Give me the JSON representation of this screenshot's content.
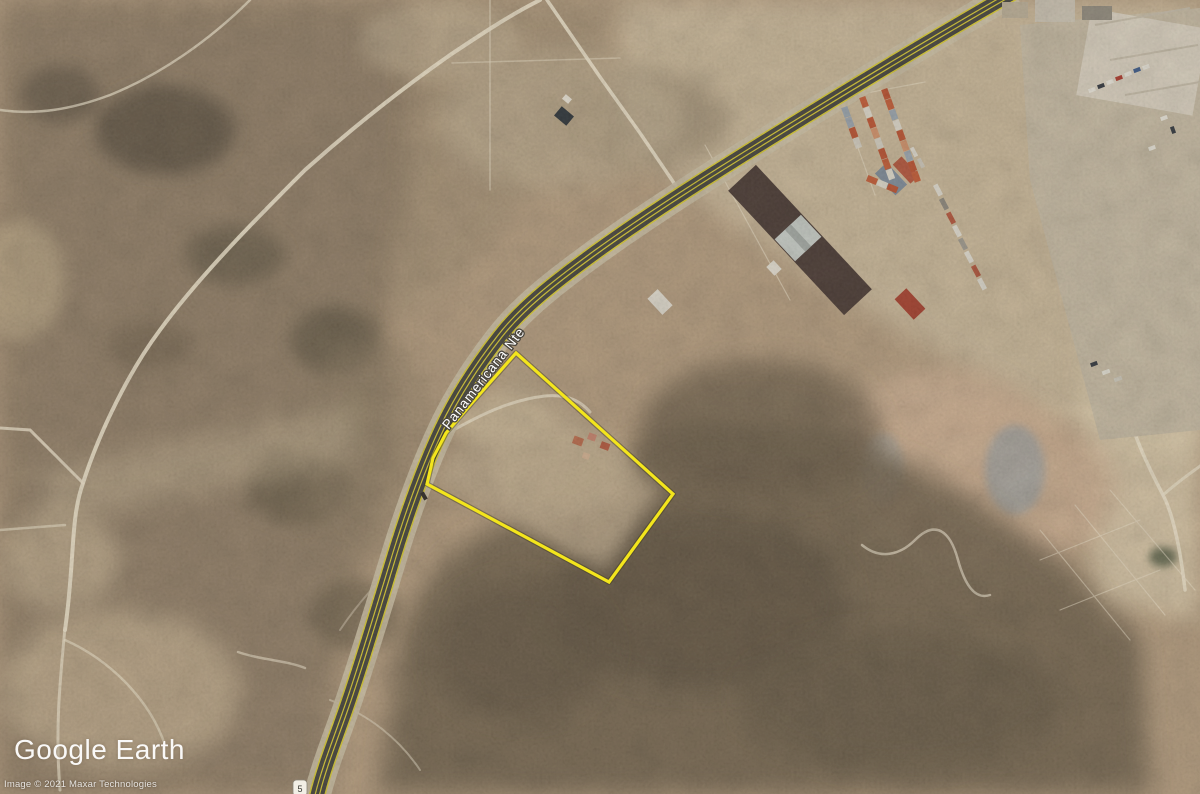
{
  "watermark": {
    "logo": "Google Earth",
    "attribution": "Image © 2021 Maxar Technologies"
  },
  "overlay": {
    "road_label": "Panamericana Nte",
    "shield_label": "5",
    "parcel": {
      "outline_color": "#f3e51c",
      "points": "516,353 673,494 609,582 427,484 433,458 446,433 471,404"
    }
  },
  "colors": {
    "terrain_base": "#b1997b",
    "scrub_dark": "#6d5e49",
    "dirt_light": "#c8b697",
    "trail": "#eadfc7",
    "asphalt": "#45433b",
    "road_stripe": "#d6c832",
    "shoulder": "#c9bda1"
  },
  "container_yard": {
    "rows": [
      {
        "x": 846,
        "y": 112,
        "angle": 70,
        "units": [
          "#97a1a9",
          "#9aa3ab",
          "#b8512f",
          "#cfc9bb"
        ]
      },
      {
        "x": 864,
        "y": 102,
        "angle": 70,
        "units": [
          "#c05a35",
          "#d9d3c5",
          "#b8512f",
          "#cf9068",
          "#d0cabc",
          "#b8512f",
          "#c05a35",
          "#d9d3c5"
        ]
      },
      {
        "x": 886,
        "y": 94,
        "angle": 70,
        "units": [
          "#b8512f",
          "#c05a35",
          "#9aa3ab",
          "#d9d3c5",
          "#b8512f",
          "#cf9068",
          "#9aa3ab",
          "#b8512f",
          "#c05a35"
        ]
      },
      {
        "x": 872,
        "y": 180,
        "angle": 22,
        "units": [
          "#c05a35",
          "#d9d3c5",
          "#b8512f"
        ]
      }
    ]
  },
  "vehicles": [
    [
      1092,
      90,
      -20,
      "#e6e2d6",
      7,
      4
    ],
    [
      1101,
      86,
      -20,
      "#33373d",
      7,
      4
    ],
    [
      1110,
      82,
      -20,
      "#e6e2d6",
      7,
      4
    ],
    [
      1119,
      78,
      -20,
      "#ab392b",
      7,
      4
    ],
    [
      1128,
      74,
      -20,
      "#e6e2d6",
      7,
      4
    ],
    [
      1137,
      70,
      -20,
      "#3d5a88",
      7,
      4
    ],
    [
      1146,
      67,
      -20,
      "#e6e2d6",
      7,
      4
    ],
    [
      1164,
      118,
      -20,
      "#e6e2d6",
      7,
      4
    ],
    [
      1173,
      130,
      70,
      "#33373d",
      7,
      4
    ],
    [
      1152,
      148,
      -20,
      "#e6e2d6",
      7,
      4
    ],
    [
      938,
      190,
      62,
      "#ddd8cc",
      12,
      5
    ],
    [
      944,
      204,
      62,
      "#8a8478",
      12,
      5
    ],
    [
      951,
      218,
      62,
      "#b0543a",
      12,
      5
    ],
    [
      957,
      231,
      62,
      "#ddd8cc",
      12,
      5
    ],
    [
      963,
      244,
      62,
      "#9a9488",
      12,
      5
    ],
    [
      969,
      257,
      62,
      "#ddd8cc",
      12,
      5
    ],
    [
      976,
      271,
      62,
      "#b0543a",
      12,
      5
    ],
    [
      982,
      284,
      62,
      "#ddd8cc",
      12,
      5
    ],
    [
      914,
      152,
      62,
      "#ddd8cc",
      10,
      4
    ],
    [
      921,
      163,
      62,
      "#c8c2b4",
      10,
      4
    ],
    [
      1106,
      372,
      -20,
      "#e0dccf",
      8,
      4
    ],
    [
      1118,
      379,
      -20,
      "#c9c4b6",
      8,
      4
    ],
    [
      1094,
      364,
      -20,
      "#33373d",
      7,
      4
    ]
  ]
}
